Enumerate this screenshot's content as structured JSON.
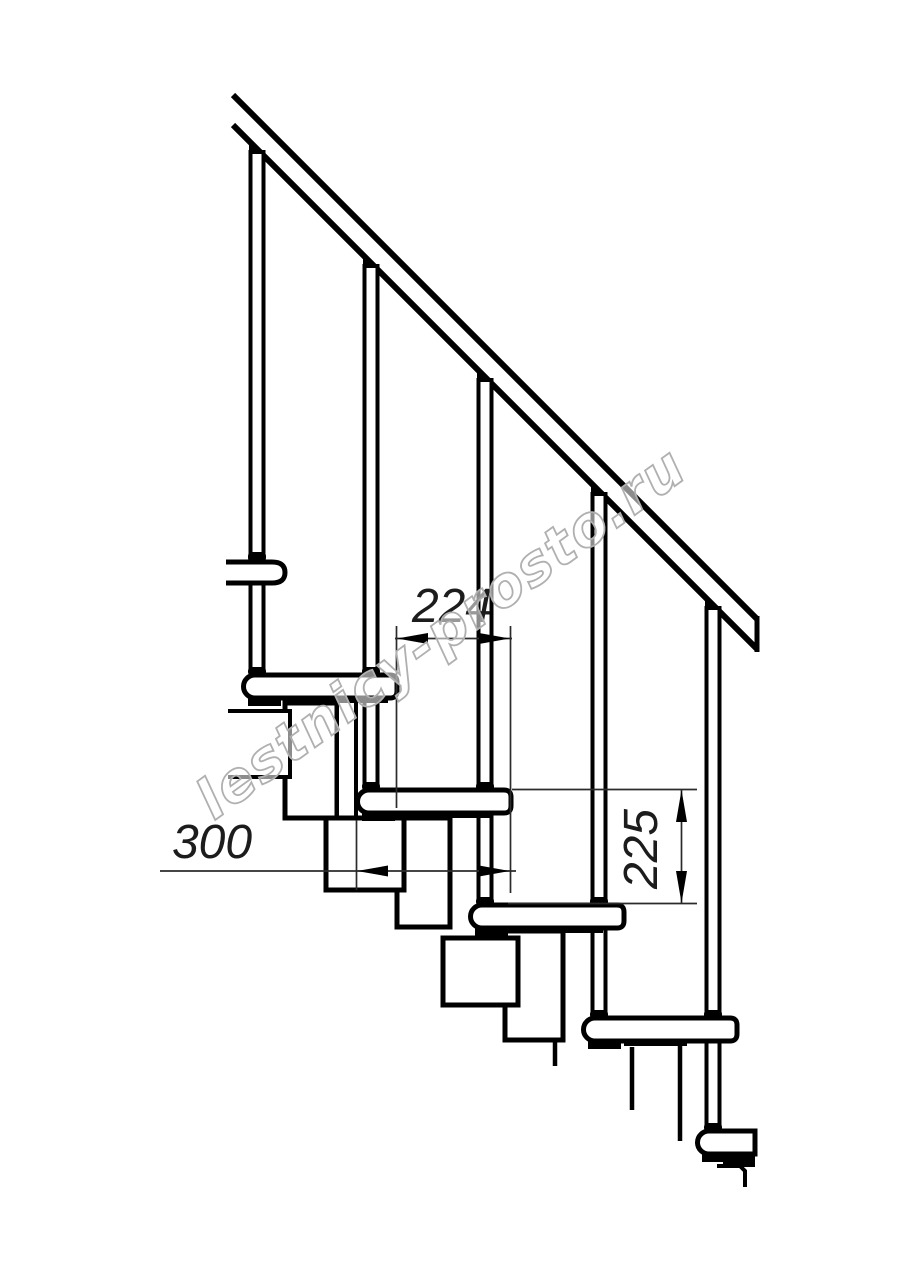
{
  "drawing": {
    "background": "#ffffff",
    "line_color": "#000000",
    "thin_line_color": "#2b2b2b",
    "subject": "modular-staircase-side-elevation",
    "elements": {
      "treads": 5,
      "balusters": 5,
      "handrail": true,
      "support_modules": true
    },
    "dimensions": [
      {
        "id": "step-run",
        "label": "224",
        "orientation": "horizontal"
      },
      {
        "id": "tread-length",
        "label": "300",
        "orientation": "horizontal"
      },
      {
        "id": "riser-height",
        "label": "225",
        "orientation": "vertical"
      }
    ],
    "watermark": {
      "text": "lestnicy-prosto.ru",
      "color": "#b0b0b0"
    }
  }
}
